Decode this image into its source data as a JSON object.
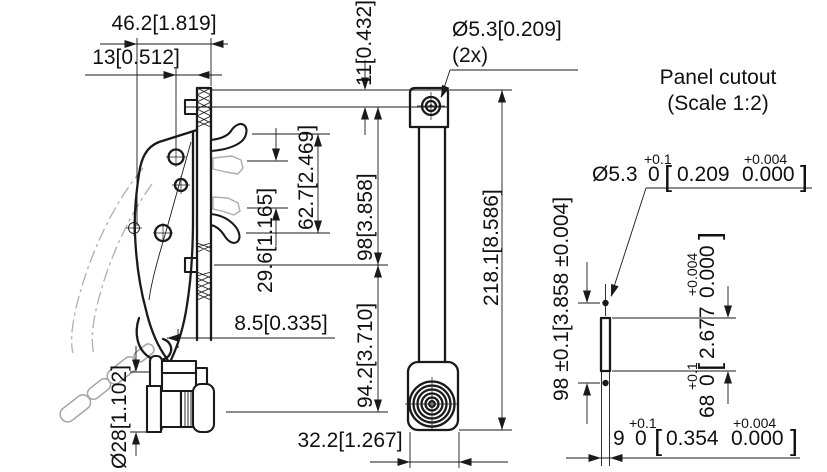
{
  "drawing": {
    "labels": {
      "panel_cutout_title": "Panel cutout",
      "panel_cutout_scale": "(Scale 1:2)"
    },
    "dims": {
      "handle_width": "46.2[1.819]",
      "hole_to_face": "13[0.512]",
      "top_to_hole": "11[0.432]",
      "mount_hole": "Ø5.3[0.209]",
      "mount_hole_qty": "(2x)",
      "hook_open_span": "29.6[1.165]",
      "hook_span": "62.7[2.469]",
      "mount_span": "98[3.858]",
      "total_length": "218.1[8.586]",
      "wall_thickness": "8.5[0.335]",
      "lower_span": "94.2[3.710]",
      "lock_diameter": "Ø28[1.102]",
      "base_width": "32.2[1.267]",
      "cutout_height": "98 ±0.1[3.858 ±0.004]",
      "cutout_hole": {
        "mm": "Ø5.3",
        "hi": "+0.1",
        "lo": "0",
        "ob": "[",
        "inch": "0.209",
        "ihi": "+0.004",
        "ilo": "0.000",
        "cb": "]"
      },
      "cutout_slot_height": {
        "mm": "68",
        "hi": "+0.1",
        "lo": "0",
        "ob": "[",
        "inch": "2.677",
        "ihi": "+0.004",
        "ilo": "0.000",
        "cb": "]"
      },
      "cutout_slot_width": {
        "mm": "9",
        "hi": "+0.1",
        "lo": "0",
        "ob": "[",
        "inch": "0.354",
        "ihi": "+0.004",
        "ilo": "0.000",
        "cb": "]"
      }
    },
    "colors": {
      "line": "#1a1a1a",
      "ghost": "#adadad",
      "background": "#ffffff"
    }
  }
}
